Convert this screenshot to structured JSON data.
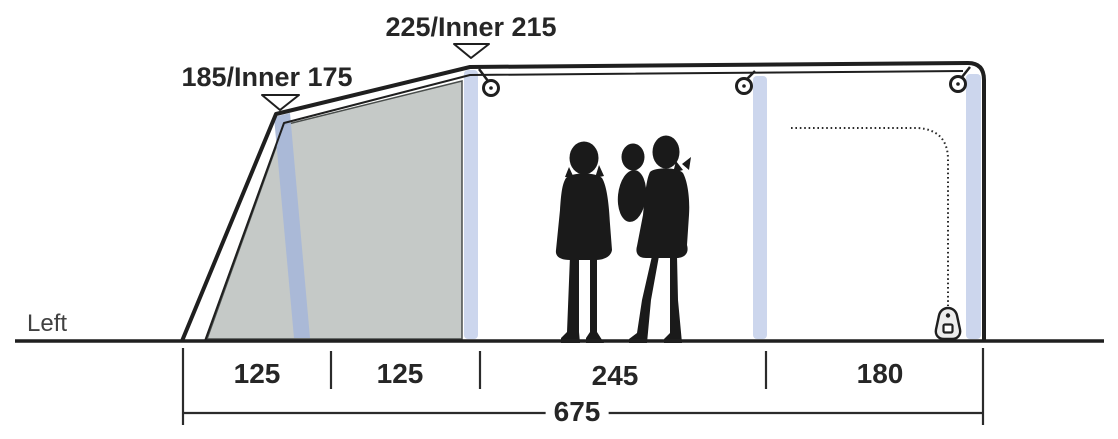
{
  "labels": {
    "view": "Left"
  },
  "heights": {
    "front": "185/Inner 175",
    "main": "225/Inner 215"
  },
  "floor": {
    "sections": [
      "125",
      "125",
      "245",
      "180"
    ],
    "total": "675"
  },
  "icons": {
    "height_marker_icon": "open triangle pointing down",
    "grommet_icon": "double-ring eyelet",
    "zipper_pull_icon": "zipper slider on dotted door seam"
  },
  "colors": {
    "outline": "#1f1f1f",
    "inner_panel_gray": "#c5c9c7",
    "air_pole_blue": "#ccd6ed",
    "beam_blue": "#a9b8d8",
    "silhouette": "#1a1a1a",
    "dimension_text": "#262626",
    "background": "#ffffff"
  }
}
